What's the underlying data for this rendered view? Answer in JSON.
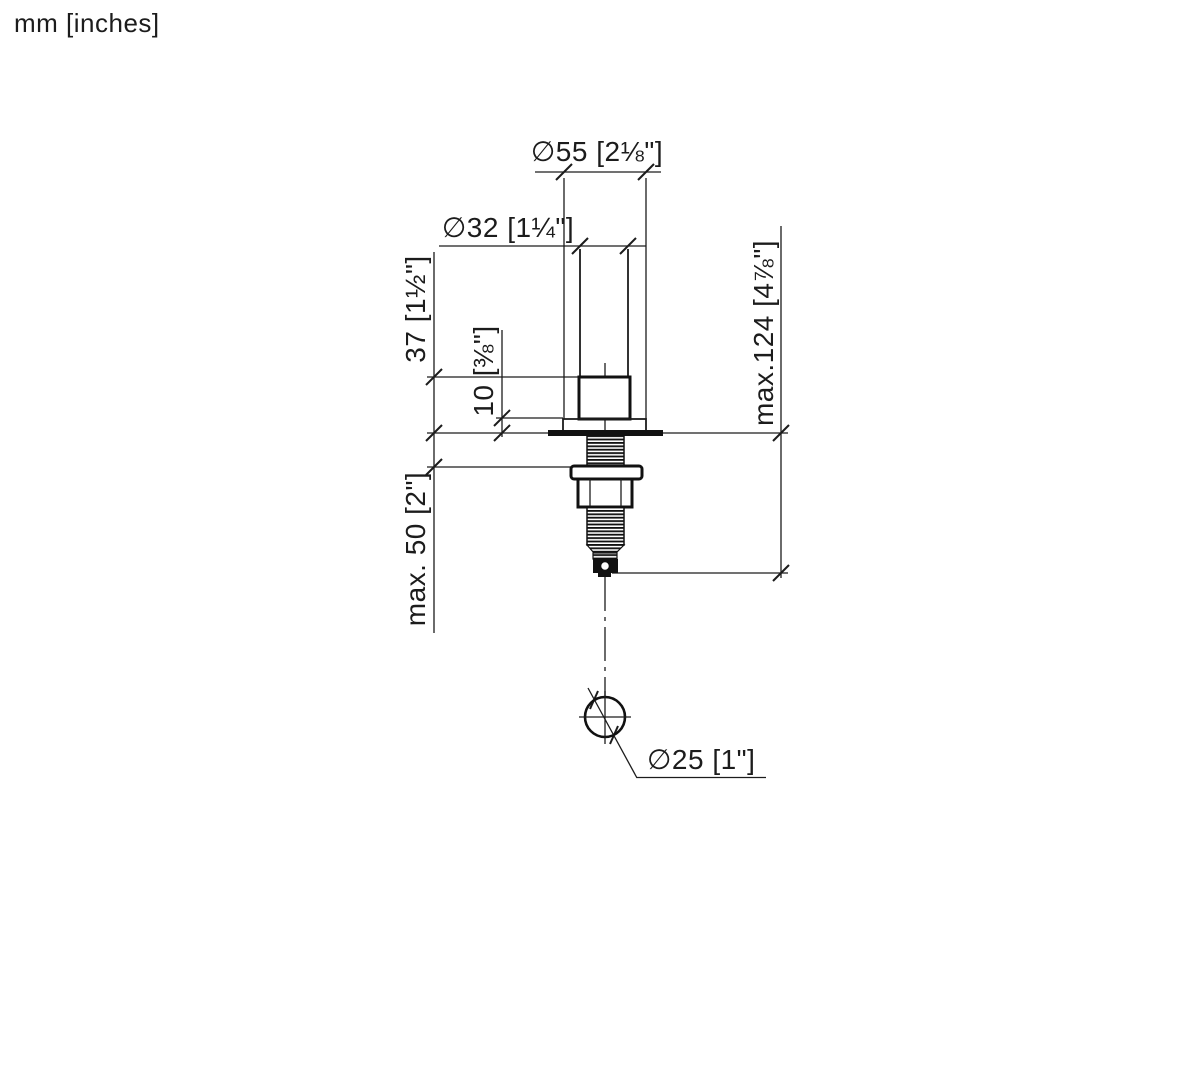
{
  "page": {
    "background": "#ffffff",
    "line_color": "#1c1c1c",
    "units_label": "mm [inches]"
  },
  "drawing": {
    "dimensions": {
      "flange_diameter": "∅55 [2⅛\"]",
      "handle_diameter": "∅32 [1¼\"]",
      "body_height": "37 [1½\"]",
      "flange_height": "10 [⅜\"]",
      "max_below_deck": "max.124 [4⅞\"]",
      "max_deck_thickness": "max. 50 [2\"]",
      "hole_diameter": "∅25 [1\"]"
    }
  }
}
